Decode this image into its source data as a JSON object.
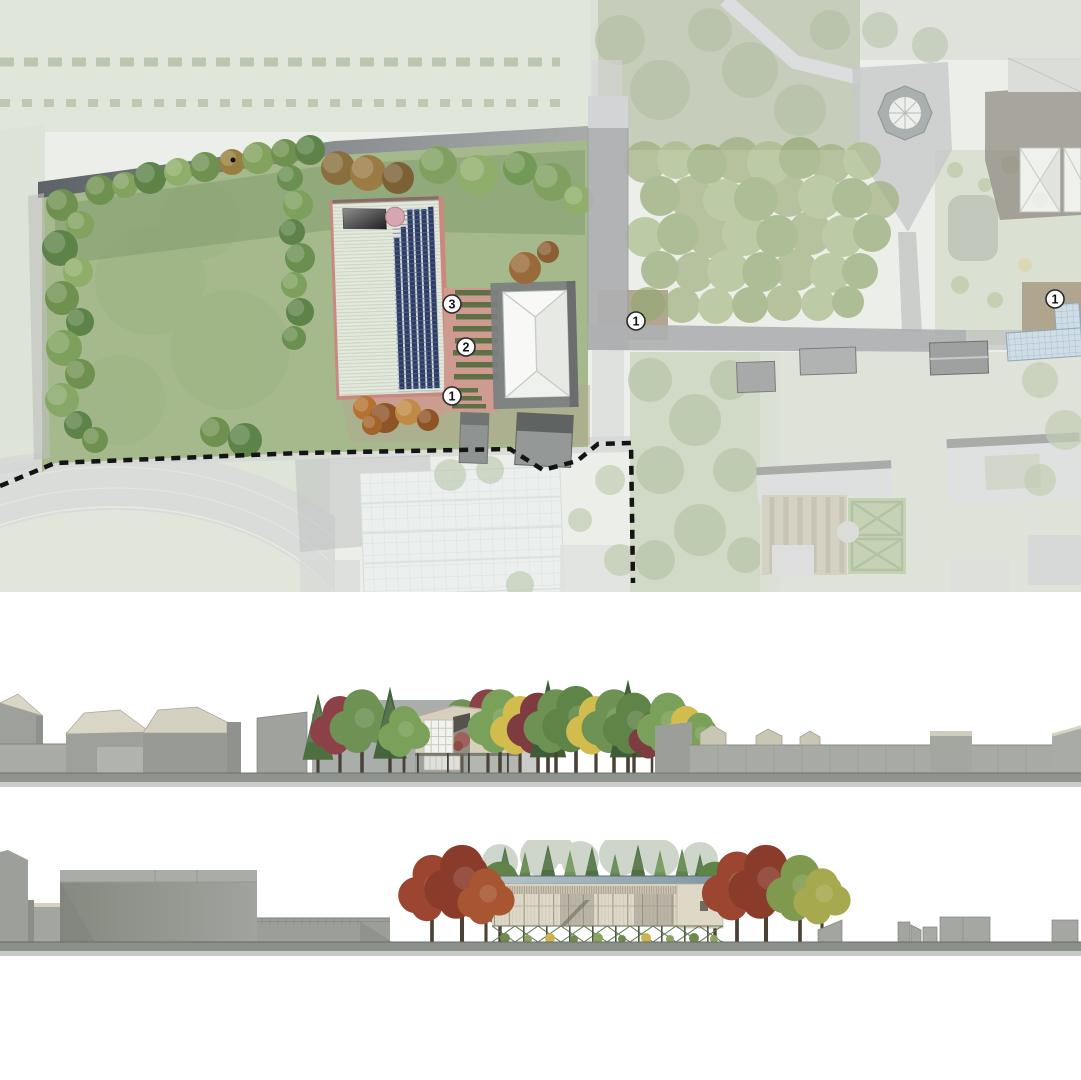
{
  "site_plan": {
    "markers": [
      {
        "label": "3"
      },
      {
        "label": "2"
      },
      {
        "label": "1"
      },
      {
        "label": "1"
      },
      {
        "label": "1"
      }
    ]
  },
  "palette": {
    "lawn": "#a5b98c",
    "orchard_canopy": "#9eb07e",
    "terrace": "#cf9a90",
    "planting_strip": "#5d7046",
    "solar_panel": "#2e3c5f",
    "metal_roof": "#e4e9de",
    "white_roof": "#f8f9f6",
    "road": "#aeb0b1",
    "boundary_line": "#141414",
    "track": "#bfc3c0",
    "context_gray": "#9b9e99",
    "roof_cream": "#d9d6c6",
    "facade_beige": "#d8d0bf",
    "pavilion_roof_blue": "#8ba2ad",
    "truss_green": "#5c7a50",
    "autumn_red": "#9c4530",
    "autumn_yellow": "#d2bc4e",
    "tree_green": "#6d9254",
    "conifer_green": "#4e6f40",
    "ground_strip": "#8f938e"
  }
}
